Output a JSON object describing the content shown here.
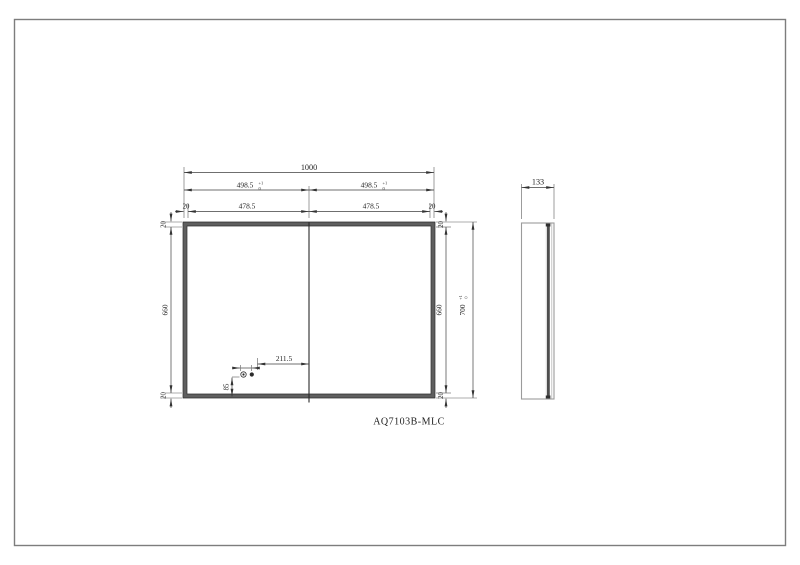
{
  "page": {
    "border_color": "#7d7d7d",
    "background": "#ffffff"
  },
  "title_label": "AQ7103B-MLC",
  "colors": {
    "frame_fill": "#5f5f5f",
    "door_fill": "#4d4d4d",
    "line": "#3f3f3f"
  },
  "front_view": {
    "total_width": "1000",
    "half_width_left": {
      "v": "498.5",
      "tol_top": "+1",
      "tol_bottom": "0"
    },
    "half_width_right": {
      "v": "498.5",
      "tol_top": "+1",
      "tol_bottom": "0"
    },
    "frame_top_left": "20",
    "inner_width_left": "478.5",
    "inner_width_right": "478.5",
    "frame_top_right": "20",
    "left_frame_top": "20",
    "left_inner_height": "660",
    "left_frame_bottom": "20",
    "right_frame_top": "20",
    "right_inner_height": "660",
    "right_frame_bottom": "20",
    "total_height": {
      "v": "700",
      "tol_top": "+1",
      "tol_bottom": "0"
    },
    "sensor_offset_from_center": "211.5",
    "sensor_height_from_bottom": "85"
  },
  "side_view": {
    "depth": "133"
  }
}
